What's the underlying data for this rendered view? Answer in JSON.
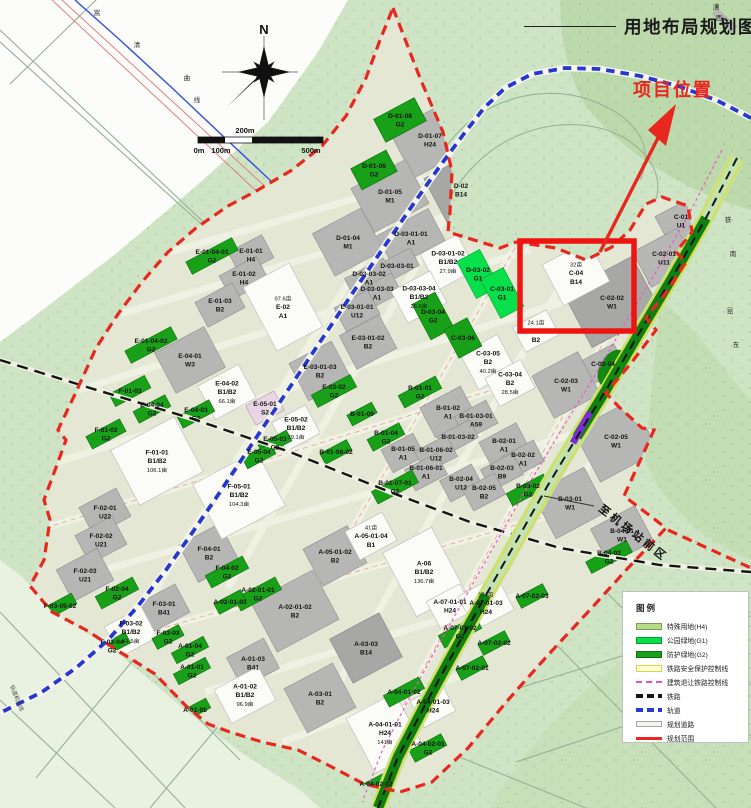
{
  "title": {
    "text": "用地布局规划图"
  },
  "annotations": {
    "project_location": "项目位置",
    "to_airport": "至机场站前区",
    "left_line_label": "轨道机场线"
  },
  "scale_bar": {
    "labels": [
      "0m",
      "100m",
      "200m",
      "500m"
    ]
  },
  "legend": {
    "title": "图例",
    "items": [
      {
        "label": "特殊用地(H4)",
        "type": "fill",
        "color": "#b7dc86"
      },
      {
        "label": "公园绿地(G1)",
        "type": "fill",
        "color": "#07e04a"
      },
      {
        "label": "防护绿地(G2)",
        "type": "fill",
        "color": "#18a018"
      },
      {
        "label": "铁路安全保护控制线",
        "type": "yellow"
      },
      {
        "label": "建筑退让铁路控制线",
        "type": "pinkdash"
      },
      {
        "label": "铁路",
        "type": "blackdash"
      },
      {
        "label": "轨道",
        "type": "bluedash"
      },
      {
        "label": "规划道路",
        "type": "road"
      },
      {
        "label": "规划范围",
        "type": "redline"
      }
    ]
  },
  "colors": {
    "boundary": "#e8281e",
    "highlight_rect": "#ee1511",
    "rail_blue": "#2638cf",
    "park_green": "#07e04a",
    "buffer_green": "#18a018",
    "special_green": "#b7dc86"
  },
  "map": {
    "north_label": "N",
    "chars": [
      {
        "t": "嵩",
        "x": 97,
        "y": 15
      },
      {
        "t": "清",
        "x": 137,
        "y": 47
      },
      {
        "t": "曲",
        "x": 187,
        "y": 80
      },
      {
        "t": "线",
        "x": 197,
        "y": 102
      },
      {
        "t": "漕",
        "x": 716,
        "y": 9
      },
      {
        "t": "西",
        "x": 719,
        "y": 20
      },
      {
        "t": "铁",
        "x": 728,
        "y": 222
      },
      {
        "t": "南",
        "x": 733,
        "y": 256
      },
      {
        "t": "昆",
        "x": 730,
        "y": 313
      },
      {
        "t": "东",
        "x": 736,
        "y": 347
      }
    ],
    "parcels": [
      {
        "c": "D-01-08",
        "u": "G2",
        "x": 400,
        "y": 120,
        "w": 46,
        "h": 26,
        "f": "gn"
      },
      {
        "c": "D-01-07",
        "u": "H24",
        "x": 430,
        "y": 140,
        "w": 64,
        "h": 52,
        "f": "g"
      },
      {
        "c": "D-01-06",
        "u": "G2",
        "x": 374,
        "y": 170,
        "w": 40,
        "h": 24,
        "f": "gn"
      },
      {
        "c": "D-01-05",
        "u": "M1",
        "x": 390,
        "y": 196,
        "w": 62,
        "h": 50,
        "f": "g"
      },
      {
        "c": "D-02",
        "u": "B14",
        "x": 461,
        "y": 190,
        "w": 55,
        "h": 55,
        "f": "g2"
      },
      {
        "c": "D-01-04",
        "u": "M1",
        "x": 348,
        "y": 242,
        "w": 55,
        "h": 48,
        "f": "g"
      },
      {
        "c": "D-03-01-01",
        "u": "A1",
        "x": 411,
        "y": 238,
        "w": 58,
        "h": 36,
        "f": "g"
      },
      {
        "c": "D-03-01-02",
        "u": "B1/B2",
        "a": "27.9亩",
        "x": 448,
        "y": 262,
        "w": 42,
        "h": 40,
        "f": "w"
      },
      {
        "c": "D-03-02",
        "u": "G1",
        "x": 478,
        "y": 274,
        "w": 26,
        "h": 42,
        "f": "gb"
      },
      {
        "c": "D-03-03-01",
        "x": 397,
        "y": 266,
        "w": 40,
        "h": 20,
        "f": "g"
      },
      {
        "c": "D-03-03-02",
        "u": "A1",
        "x": 369,
        "y": 278,
        "w": 44,
        "h": 22,
        "f": "g"
      },
      {
        "c": "D-03-03-03",
        "u": "A1",
        "x": 377,
        "y": 293,
        "w": 44,
        "h": 22,
        "f": "g"
      },
      {
        "c": "D-03-03-04",
        "u": "B1/B2",
        "a": "28.6亩",
        "x": 419,
        "y": 297,
        "w": 44,
        "h": 36,
        "f": "w"
      },
      {
        "c": "D-03-04",
        "u": "G2",
        "x": 433,
        "y": 316,
        "w": 26,
        "h": 40,
        "f": "gn"
      },
      {
        "c": "C-03-01",
        "u": "G1",
        "x": 502,
        "y": 293,
        "w": 26,
        "h": 44,
        "f": "gb"
      },
      {
        "c": "C-04",
        "u": "B14",
        "a": "32亩",
        "af": 1,
        "x": 576,
        "y": 273,
        "w": 52,
        "h": 46,
        "f": "w"
      },
      {
        "c": "C-01",
        "u": "U1",
        "x": 681,
        "y": 221,
        "w": 42,
        "h": 32,
        "f": "g"
      },
      {
        "c": "C-02-01",
        "u": "U11",
        "x": 664,
        "y": 258,
        "w": 50,
        "h": 40,
        "f": "g"
      },
      {
        "c": "C-02-02",
        "u": "W1",
        "x": 612,
        "y": 302,
        "w": 78,
        "h": 62,
        "f": "g2"
      },
      {
        "c": "C-02-04",
        "x": 603,
        "y": 364,
        "w": 38,
        "h": 26,
        "f": "g"
      },
      {
        "c": "C-02-03",
        "u": "W1",
        "x": 566,
        "y": 385,
        "w": 52,
        "h": 48,
        "f": "g"
      },
      {
        "c": "C-02-05",
        "u": "W1",
        "x": 616,
        "y": 441,
        "w": 66,
        "h": 58,
        "f": "g"
      },
      {
        "c": "C-03-03",
        "u": "B2",
        "a": "24.1亩",
        "af": 1,
        "x": 536,
        "y": 331,
        "w": 38,
        "h": 28,
        "f": "w"
      },
      {
        "c": "C-03-05",
        "u": "B2",
        "a": "40.2亩",
        "x": 488,
        "y": 362,
        "w": 42,
        "h": 40,
        "f": "w"
      },
      {
        "c": "C-03-04",
        "u": "B2",
        "a": "28.5亩",
        "x": 510,
        "y": 383,
        "w": 40,
        "h": 32,
        "f": "w"
      },
      {
        "c": "C-03-06",
        "x": 463,
        "y": 338,
        "w": 26,
        "h": 32,
        "f": "gn"
      },
      {
        "c": "E-01-04-01",
        "u": "G2",
        "x": 212,
        "y": 256,
        "w": 52,
        "h": 14,
        "f": "gn"
      },
      {
        "c": "E-01-01",
        "u": "H4",
        "x": 251,
        "y": 255,
        "w": 38,
        "h": 26,
        "f": "g"
      },
      {
        "c": "E-01-02",
        "u": "H4",
        "x": 244,
        "y": 278,
        "w": 42,
        "h": 27,
        "f": "g"
      },
      {
        "c": "E-01-03",
        "u": "B2",
        "x": 220,
        "y": 305,
        "w": 42,
        "h": 28,
        "f": "g"
      },
      {
        "c": "E-01-04-02",
        "u": "G2",
        "x": 151,
        "y": 345,
        "w": 52,
        "h": 14,
        "f": "gn"
      },
      {
        "c": "E-02",
        "u": "A1",
        "a": "97.6亩",
        "af": 1,
        "x": 283,
        "y": 307,
        "w": 52,
        "h": 72,
        "f": "w"
      },
      {
        "c": "E-03-01-01",
        "u": "U12",
        "x": 357,
        "y": 311,
        "w": 38,
        "h": 27,
        "f": "g"
      },
      {
        "c": "E-03-01-02",
        "u": "B2",
        "x": 368,
        "y": 342,
        "w": 45,
        "h": 38,
        "f": "g"
      },
      {
        "c": "E-03-01-03",
        "u": "B2",
        "x": 320,
        "y": 371,
        "w": 48,
        "h": 42,
        "f": "g"
      },
      {
        "c": "E-03-02",
        "u": "G2",
        "x": 334,
        "y": 391,
        "w": 44,
        "h": 14,
        "f": "gn"
      },
      {
        "c": "E-04-01",
        "u": "W3",
        "x": 190,
        "y": 360,
        "w": 56,
        "h": 46,
        "f": "g"
      },
      {
        "c": "E-04-02",
        "u": "B1/B2",
        "a": "66.1亩",
        "x": 227,
        "y": 392,
        "w": 46,
        "h": 38,
        "f": "w"
      },
      {
        "c": "E-04-04",
        "u": "G2",
        "x": 152,
        "y": 409,
        "w": 36,
        "h": 13,
        "f": "gn"
      },
      {
        "c": "E-04-03",
        "u": "G2",
        "x": 196,
        "y": 414,
        "w": 36,
        "h": 13,
        "f": "gn"
      },
      {
        "c": "E-05-01",
        "u": "S2",
        "x": 265,
        "y": 408,
        "w": 32,
        "h": 22,
        "f": "pk"
      },
      {
        "c": "E-05-02",
        "u": "B1/B2",
        "a": "39.1亩",
        "x": 296,
        "y": 428,
        "w": 38,
        "h": 32,
        "f": "w"
      },
      {
        "c": "E-05-03",
        "u": "G2",
        "x": 275,
        "y": 443,
        "w": 32,
        "h": 12,
        "f": "gn"
      },
      {
        "c": "E-05-04",
        "u": "G2",
        "x": 259,
        "y": 456,
        "w": 32,
        "h": 12,
        "f": "gn"
      },
      {
        "c": "F-01-03",
        "x": 130,
        "y": 391,
        "w": 40,
        "h": 14,
        "f": "gn"
      },
      {
        "c": "F-01-02",
        "u": "G2",
        "x": 106,
        "y": 434,
        "w": 38,
        "h": 14,
        "f": "gn"
      },
      {
        "c": "F-01-01",
        "u": "B1/B2",
        "a": "106.1亩",
        "x": 157,
        "y": 461,
        "w": 72,
        "h": 62,
        "f": "w"
      },
      {
        "c": "F-05-01",
        "u": "B1/B2",
        "a": "104.3亩",
        "x": 239,
        "y": 495,
        "w": 72,
        "h": 62,
        "f": "w"
      },
      {
        "c": "F-02-01",
        "u": "U22",
        "x": 105,
        "y": 512,
        "w": 42,
        "h": 32,
        "f": "g"
      },
      {
        "c": "F-02-02",
        "u": "U21",
        "x": 101,
        "y": 540,
        "w": 42,
        "h": 32,
        "f": "g"
      },
      {
        "c": "F-02-03",
        "u": "U21",
        "x": 85,
        "y": 575,
        "w": 46,
        "h": 36,
        "f": "g"
      },
      {
        "c": "F-02-04",
        "u": "G2",
        "x": 117,
        "y": 593,
        "w": 42,
        "h": 14,
        "f": "gn"
      },
      {
        "c": "F-03-05-02",
        "x": 60,
        "y": 606,
        "w": 32,
        "h": 12,
        "f": "gn"
      },
      {
        "c": "F-03-01",
        "u": "B41",
        "x": 164,
        "y": 608,
        "w": 42,
        "h": 32,
        "f": "g"
      },
      {
        "c": "F-03-02",
        "u": "B1/B2",
        "a": "41.5亩",
        "x": 131,
        "y": 632,
        "w": 42,
        "h": 34,
        "f": "w"
      },
      {
        "c": "F-03-03",
        "u": "G2",
        "x": 168,
        "y": 637,
        "w": 30,
        "h": 12,
        "f": "gn"
      },
      {
        "c": "F-03-04",
        "u": "G2",
        "x": 112,
        "y": 646,
        "w": 36,
        "h": 12,
        "f": "gn"
      },
      {
        "c": "F-04-01",
        "u": "B2",
        "x": 209,
        "y": 553,
        "w": 46,
        "h": 42,
        "f": "g"
      },
      {
        "c": "F-04-02",
        "u": "G2",
        "x": 227,
        "y": 572,
        "w": 42,
        "h": 14,
        "f": "gn"
      },
      {
        "c": "A-01-04",
        "u": "G2",
        "x": 190,
        "y": 650,
        "w": 36,
        "h": 12,
        "f": "gn"
      },
      {
        "c": "A-01-01",
        "u": "G2",
        "x": 192,
        "y": 671,
        "w": 36,
        "h": 12,
        "f": "gn"
      },
      {
        "c": "A-01-03",
        "u": "B41",
        "x": 253,
        "y": 663,
        "w": 42,
        "h": 34,
        "f": "g"
      },
      {
        "c": "A-01-02",
        "u": "B1/B2",
        "a": "96.9亩",
        "x": 245,
        "y": 695,
        "w": 50,
        "h": 38,
        "f": "w"
      },
      {
        "c": "A-01-05",
        "x": 195,
        "y": 710,
        "w": 30,
        "h": 11,
        "f": "gn"
      },
      {
        "c": "A-02-01-01",
        "u": "G2",
        "x": 258,
        "y": 594,
        "w": 46,
        "h": 14,
        "f": "gn"
      },
      {
        "c": "A-02-01-03",
        "x": 230,
        "y": 602,
        "w": 30,
        "h": 12,
        "f": "gn"
      },
      {
        "c": "A-02-01-02",
        "u": "B2",
        "x": 295,
        "y": 611,
        "w": 70,
        "h": 56,
        "f": "g"
      },
      {
        "c": "A-05-01-02",
        "u": "B2",
        "x": 335,
        "y": 556,
        "w": 50,
        "h": 42,
        "f": "g"
      },
      {
        "c": "A-05-01-04",
        "u": "B1",
        "a": "41亩",
        "af": 1,
        "x": 371,
        "y": 536,
        "w": 42,
        "h": 32,
        "f": "w"
      },
      {
        "c": "A-06",
        "u": "B1/B2",
        "a": "136.7亩",
        "x": 424,
        "y": 572,
        "w": 55,
        "h": 72,
        "f": "w"
      },
      {
        "c": "A-03-03",
        "u": "B14",
        "x": 366,
        "y": 648,
        "w": 56,
        "h": 50,
        "f": "g2"
      },
      {
        "c": "A-03-01",
        "u": "B2",
        "x": 320,
        "y": 698,
        "w": 55,
        "h": 50,
        "f": "g"
      },
      {
        "c": "A-04-01-01",
        "u": "H24",
        "a": "141亩",
        "x": 385,
        "y": 733,
        "w": 55,
        "h": 62,
        "f": "w"
      },
      {
        "c": "A-04-01-02",
        "x": 404,
        "y": 692,
        "w": 40,
        "h": 13,
        "f": "gn"
      },
      {
        "c": "A-04-01-03",
        "u": "H24",
        "x": 433,
        "y": 706,
        "w": 36,
        "h": 30,
        "f": "w"
      },
      {
        "c": "A-04-02-01",
        "u": "G2",
        "x": 428,
        "y": 748,
        "w": 36,
        "h": 13,
        "f": "gn"
      },
      {
        "c": "A-04-02-02",
        "x": 376,
        "y": 784,
        "w": 36,
        "h": 12,
        "f": "gn"
      },
      {
        "c": "A-07-01-01",
        "u": "H24",
        "x": 450,
        "y": 606,
        "w": 38,
        "h": 30,
        "f": "w"
      },
      {
        "c": "A-07-01-03",
        "u": "H24",
        "a": "174亩",
        "af": 1,
        "x": 486,
        "y": 603,
        "w": 44,
        "h": 38,
        "f": "w"
      },
      {
        "c": "A-07-01-02",
        "u": "G2",
        "x": 460,
        "y": 632,
        "w": 42,
        "h": 14,
        "f": "gn"
      },
      {
        "c": "A-07-02-03",
        "x": 532,
        "y": 596,
        "w": 30,
        "h": 12,
        "f": "gn"
      },
      {
        "c": "A-07-02-02",
        "x": 494,
        "y": 643,
        "w": 30,
        "h": 12,
        "f": "gn"
      },
      {
        "c": "A-07-02-01",
        "x": 472,
        "y": 668,
        "w": 30,
        "h": 12,
        "f": "gn"
      },
      {
        "c": "B-01-09",
        "x": 362,
        "y": 414,
        "w": 28,
        "h": 12,
        "f": "gn"
      },
      {
        "c": "B-01-04",
        "u": "G2",
        "x": 386,
        "y": 437,
        "w": 36,
        "h": 13,
        "f": "gn"
      },
      {
        "c": "B-01-01",
        "u": "G2",
        "x": 420,
        "y": 392,
        "w": 42,
        "h": 14,
        "f": "gn"
      },
      {
        "c": "B-01-02",
        "u": "A1",
        "x": 448,
        "y": 412,
        "w": 46,
        "h": 34,
        "f": "g"
      },
      {
        "c": "B-01-03-01",
        "u": "A59",
        "x": 476,
        "y": 420,
        "w": 36,
        "h": 26,
        "f": "g"
      },
      {
        "c": "B-01-03-02",
        "x": 458,
        "y": 437,
        "w": 36,
        "h": 20,
        "f": "g"
      },
      {
        "c": "B-01-05",
        "u": "A1",
        "x": 403,
        "y": 453,
        "w": 36,
        "h": 26,
        "f": "g"
      },
      {
        "c": "B-01-06-02",
        "u": "U12",
        "x": 436,
        "y": 454,
        "w": 36,
        "h": 24,
        "f": "g"
      },
      {
        "c": "B-01-06-01",
        "u": "A1",
        "x": 426,
        "y": 472,
        "w": 36,
        "h": 24,
        "f": "g"
      },
      {
        "c": "B-01-07-01",
        "u": "G2",
        "x": 395,
        "y": 487,
        "w": 46,
        "h": 14,
        "f": "gn"
      },
      {
        "c": "B-01-08-02",
        "x": 336,
        "y": 452,
        "w": 30,
        "h": 12,
        "f": "gn"
      },
      {
        "c": "B-02-01",
        "u": "A1",
        "x": 504,
        "y": 445,
        "w": 42,
        "h": 28,
        "f": "g"
      },
      {
        "c": "B-02-02",
        "u": "A1",
        "x": 523,
        "y": 459,
        "w": 36,
        "h": 24,
        "f": "g"
      },
      {
        "c": "B-02-03",
        "u": "B9",
        "x": 502,
        "y": 472,
        "w": 36,
        "h": 24,
        "f": "g"
      },
      {
        "c": "B-02-04",
        "u": "U12",
        "x": 461,
        "y": 483,
        "w": 36,
        "h": 24,
        "f": "g"
      },
      {
        "c": "B-02-05",
        "u": "B2",
        "x": 484,
        "y": 492,
        "w": 36,
        "h": 24,
        "f": "g"
      },
      {
        "c": "B-03-02",
        "u": "G2",
        "x": 528,
        "y": 490,
        "w": 42,
        "h": 14,
        "f": "gn"
      },
      {
        "c": "B-03-01",
        "u": "W1",
        "x": 570,
        "y": 503,
        "w": 58,
        "h": 50,
        "f": "g"
      },
      {
        "c": "B-04-01",
        "u": "W1",
        "x": 622,
        "y": 535,
        "w": 50,
        "h": 40,
        "f": "g"
      },
      {
        "c": "B-04-02",
        "u": "G2",
        "x": 609,
        "y": 557,
        "w": 46,
        "h": 13,
        "f": "gn"
      }
    ]
  }
}
